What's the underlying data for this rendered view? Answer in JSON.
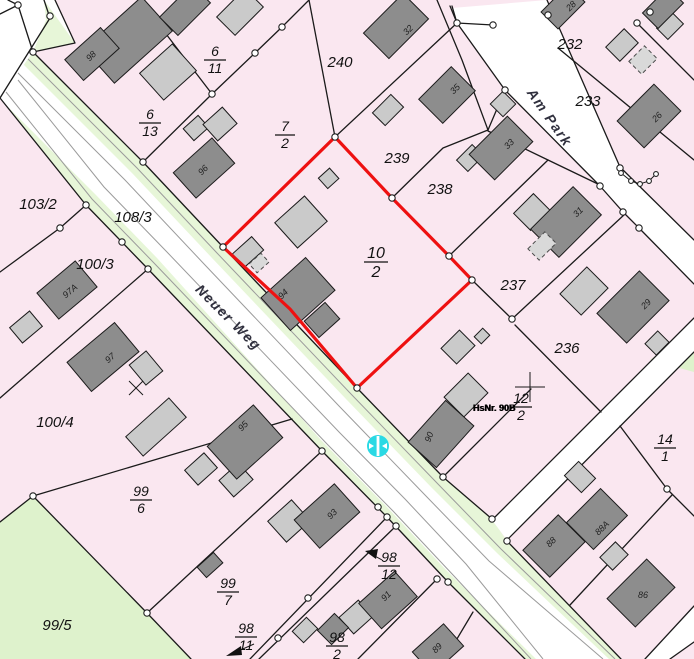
{
  "map": {
    "streets": {
      "neuer_weg": "Neuer Weg",
      "am_park": "Am Park"
    },
    "selected_parcel": {
      "n": "10",
      "d": "2",
      "outline_color": "#ee1111"
    },
    "parcels": {
      "p240": "240",
      "p239": "239",
      "p238": "238",
      "p237": "237",
      "p236": "236",
      "p232": "232",
      "p233": "233",
      "p103_2": "103/2",
      "p108_3": "108/3",
      "p100_3": "100/3",
      "p100_4": "100/4",
      "p99_5": "99/5"
    },
    "fractions": {
      "f6_11": {
        "n": "6",
        "d": "11"
      },
      "f6_13": {
        "n": "6",
        "d": "13"
      },
      "f7_2": {
        "n": "7",
        "d": "2"
      },
      "f12_2": {
        "n": "12",
        "d": "2"
      },
      "f14_1": {
        "n": "14",
        "d": "1"
      },
      "f99_6": {
        "n": "99",
        "d": "6"
      },
      "f99_7": {
        "n": "99",
        "d": "7"
      },
      "f98_11": {
        "n": "98",
        "d": "11"
      },
      "f98_12": {
        "n": "98",
        "d": "12"
      },
      "f98_2": {
        "n": "98",
        "d": "2"
      }
    },
    "buildings": {
      "b98": "98",
      "b96": "96",
      "b97a": "97A",
      "b97": "97",
      "b95": "95",
      "b94": "94",
      "b93": "93",
      "b91": "91",
      "b89": "89",
      "b90": "90",
      "b88": "88",
      "b88a": "88A",
      "b86": "86",
      "b32": "32",
      "b35": "35",
      "b33": "33",
      "b31": "31",
      "b29": "29",
      "b26": "26",
      "b28": "28"
    },
    "annotations": {
      "house_number": "HsNr. 90B"
    },
    "colors": {
      "parcel_fill": "#fae7f0",
      "road_fill": "#ffffff",
      "verge_fill": "#e7f6d8",
      "green_area_fill": "#def2cc",
      "building_dark": "#8d8d8d",
      "building_light": "#cacaca",
      "boundary": "#1a1a1a",
      "selected_outline": "#ee1111",
      "hydrant_marker": "#2ad9e4"
    }
  }
}
